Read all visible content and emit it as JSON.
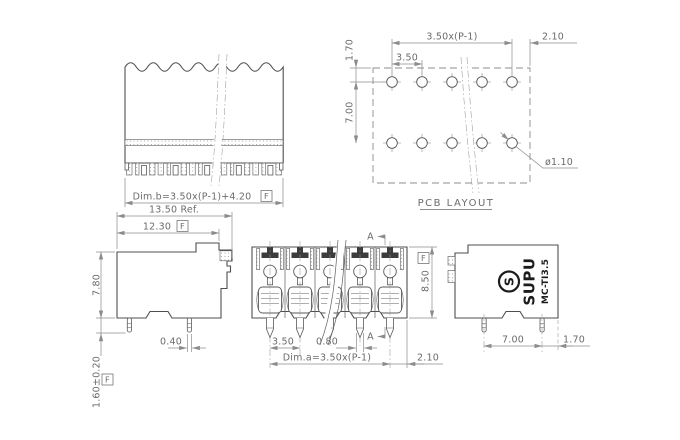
{
  "drawing": {
    "flag": "F",
    "section_label": "A",
    "top_view": {
      "dim_b": "Dim.b=3.50x(P-1)+4.20"
    },
    "pcb_layout": {
      "title": "PCB LAYOUT",
      "dim_span": "3.50x(P-1)",
      "dim_right_edge": "2.10",
      "dim_pitch": "3.50",
      "dim_top_offset": "1.70",
      "dim_row_spacing": "7.00",
      "dim_hole_diameter": "ø1.10"
    },
    "side_view_left": {
      "dim_overall_ref": "13.50 Ref.",
      "dim_body_width": "12.30",
      "dim_body_height": "7.80",
      "dim_pin_width": "0.40",
      "dim_pin_length": "1.60±0.20"
    },
    "front_view": {
      "dim_pitch": "3.50",
      "dim_pin_width": "0.80",
      "dim_a": "Dim.a=3.50x(P-1)",
      "dim_right_edge": "2.10",
      "dim_height": "8.50"
    },
    "side_view_right": {
      "brand": "SUPU",
      "model": "MC-TI3.5",
      "dim_pin_spacing": "7.00",
      "dim_edge": "1.70"
    }
  }
}
